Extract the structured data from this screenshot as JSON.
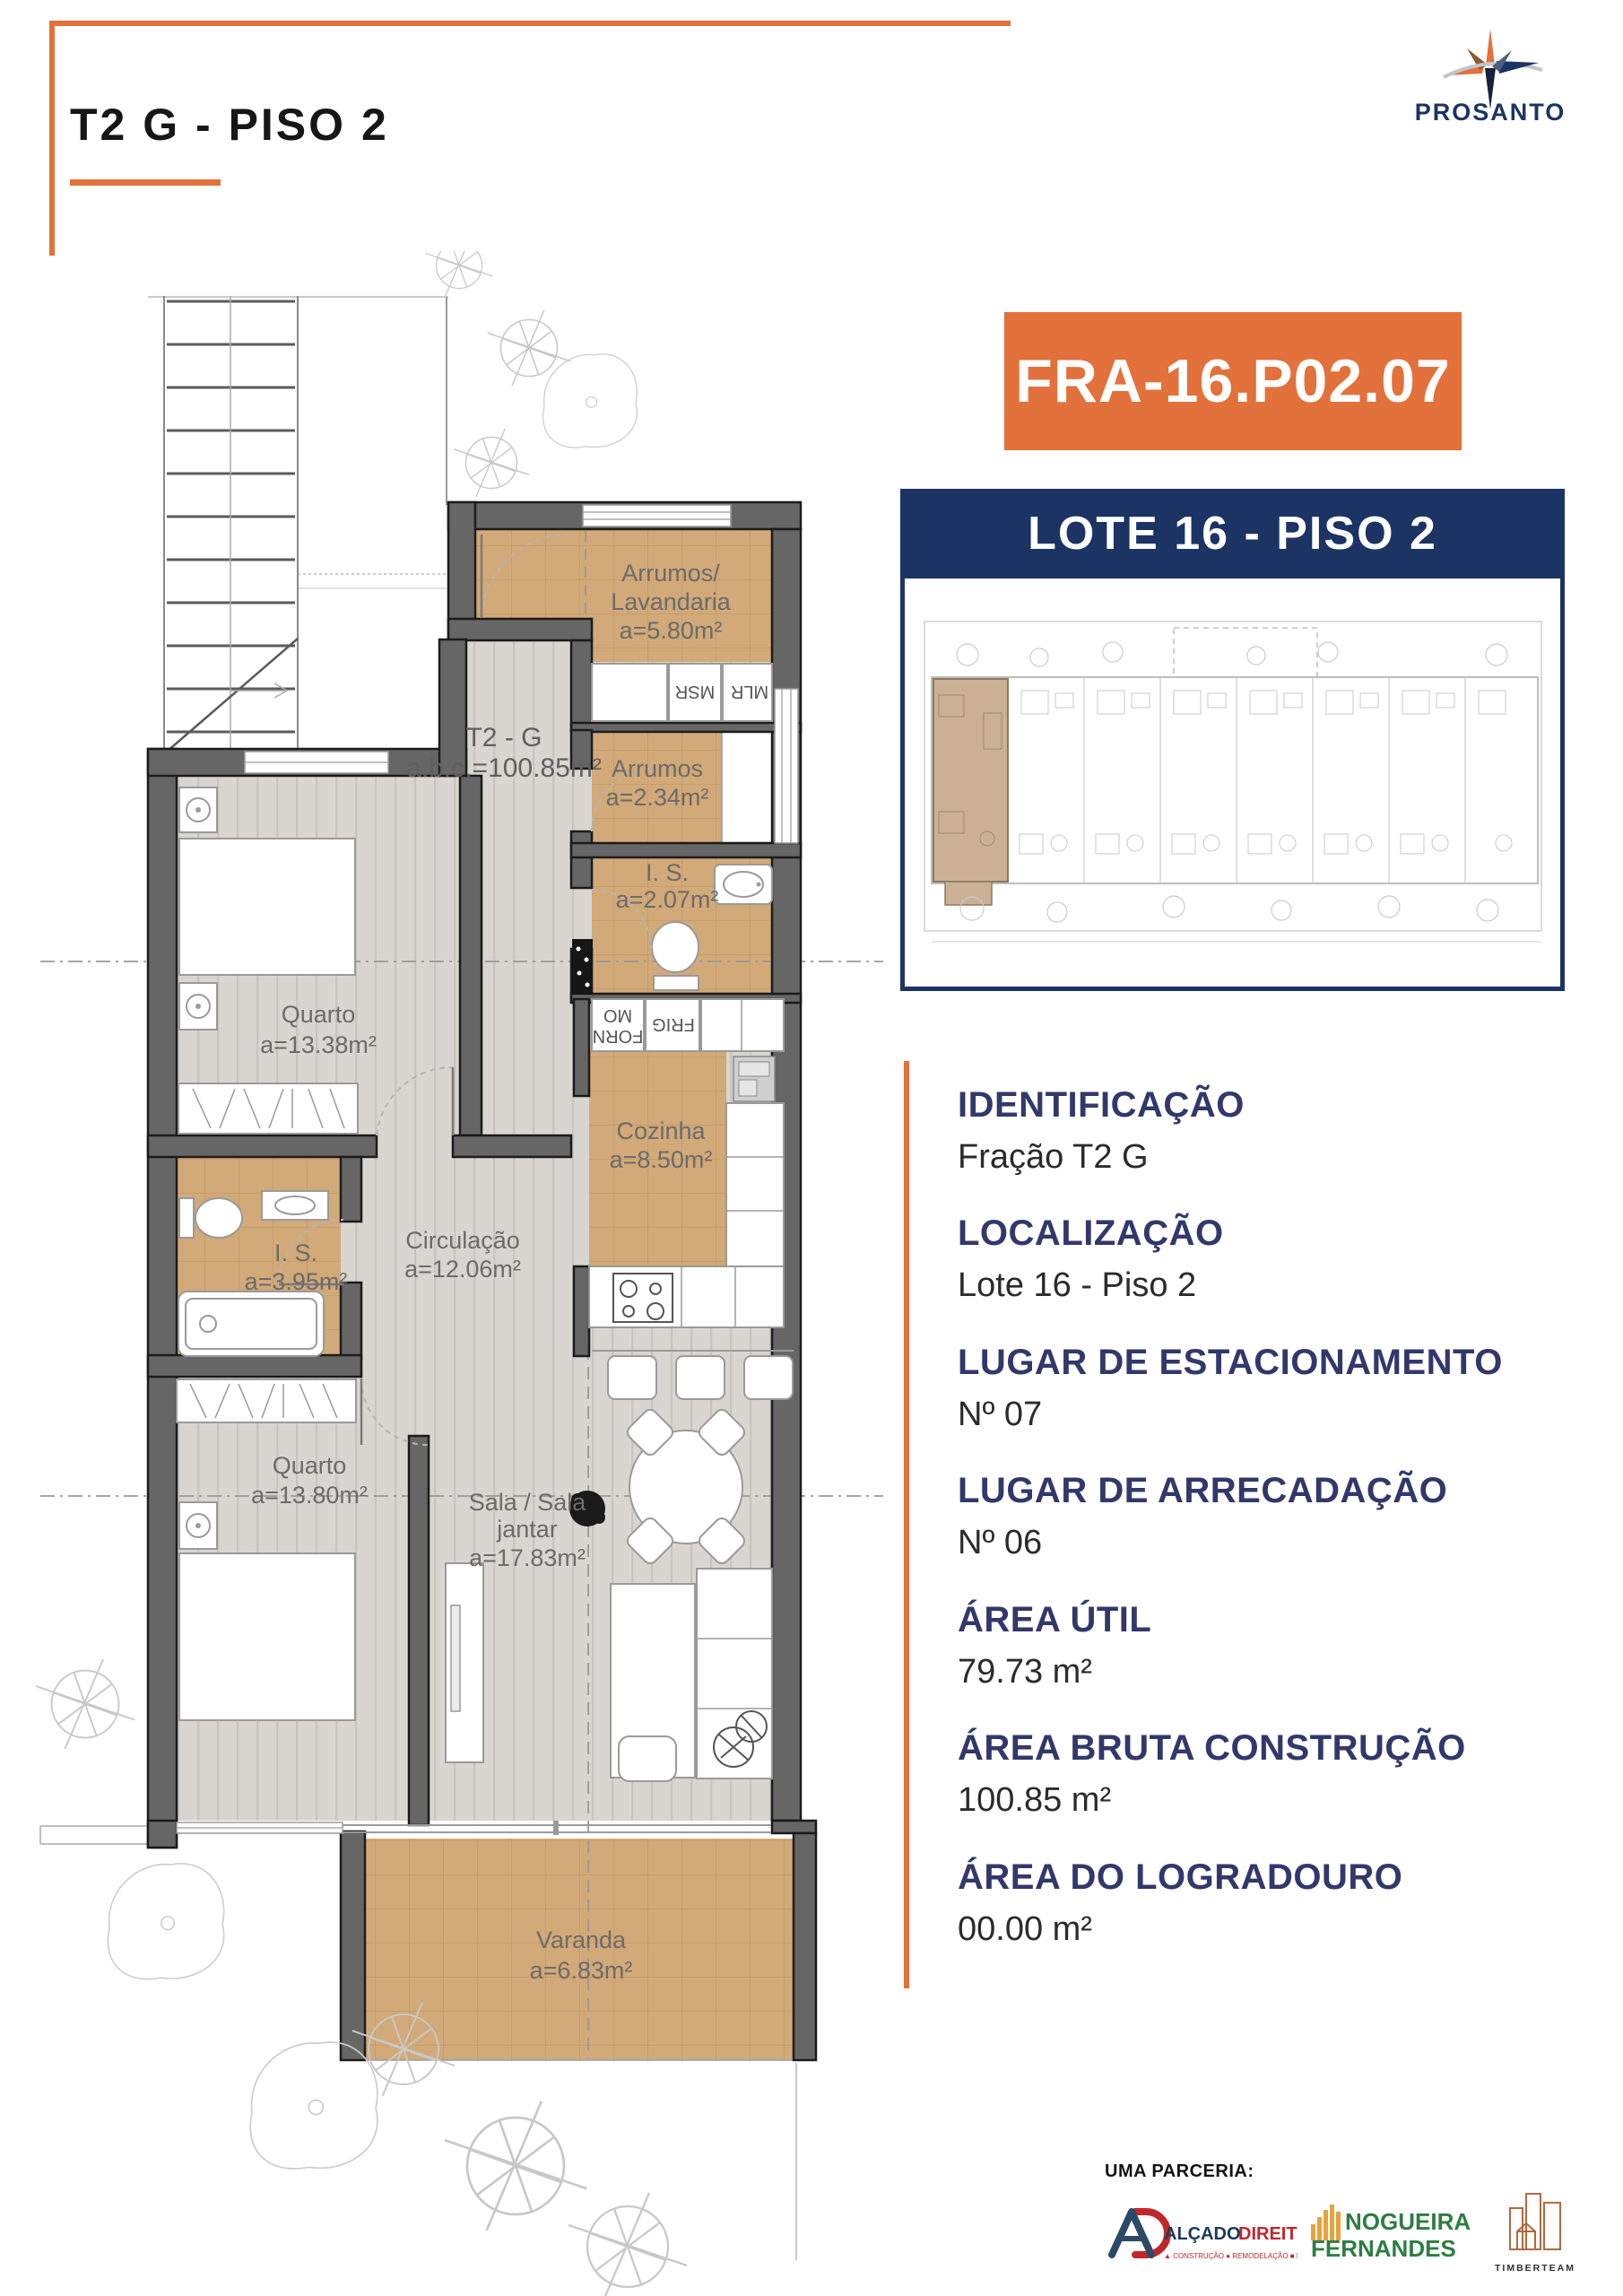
{
  "header": {
    "title": "T2 G - PISO 2",
    "logo_text": "PROSANTO"
  },
  "badge": {
    "code": "FRA-16.P02.07"
  },
  "lote_banner": {
    "label": "LOTE 16 - PISO 2"
  },
  "details": {
    "sections": [
      {
        "heading": "IDENTIFICAÇÃO",
        "value": "Fração T2 G"
      },
      {
        "heading": "LOCALIZAÇÃO",
        "value": "Lote 16 - Piso 2"
      },
      {
        "heading": "LUGAR DE ESTACIONAMENTO",
        "value": "Nº 07"
      },
      {
        "heading": "LUGAR DE ARRECADAÇÃO",
        "value": "Nº 06"
      },
      {
        "heading": "ÁREA ÚTIL",
        "value": "79.73 m²"
      },
      {
        "heading": "ÁREA BRUTA CONSTRUÇÃO",
        "value": "100.85 m²"
      },
      {
        "heading": "ÁREA DO LOGRADOURO",
        "value": "00.00 m²"
      }
    ]
  },
  "floor_plan": {
    "unit_label": {
      "line1": "T2 - G",
      "line2": "a.b.c.=100.85m²"
    },
    "rooms": {
      "laundry": {
        "name1": "Arrumos/",
        "name2": "Lavandaria",
        "area": "a=5.80m²"
      },
      "storage": {
        "name": "Arrumos",
        "area": "a=2.34m²"
      },
      "wc1": {
        "name": "I. S.",
        "area": "a=2.07m²"
      },
      "bedroom1": {
        "name": "Quarto",
        "area": "a=13.38m²"
      },
      "kitchen": {
        "name": "Cozinha",
        "area": "a=8.50m²"
      },
      "hallway": {
        "name": "Circulação",
        "area": "a=12.06m²"
      },
      "wc2": {
        "name": "I. S.",
        "area": "a=3.95m²"
      },
      "bedroom2": {
        "name": "Quarto",
        "area": "a=13.80m²"
      },
      "living": {
        "name1": "Sala / Sala",
        "name2": "jantar",
        "area": "a=17.83m²"
      },
      "balcony": {
        "name": "Varanda",
        "area": "a=6.83m²"
      }
    },
    "appliance_labels": {
      "msr": "MSR",
      "mlr": "MLR",
      "forn": "FORN",
      "mo": "MO",
      "frig": "FRIG"
    }
  },
  "partnership": {
    "label": "UMA PARCERIA:",
    "partners": [
      {
        "name_part1": "ALÇADO",
        "name_part2": "DIREITO",
        "tagline": "▲ CONSTRUÇÃO   ● REMODELAÇÃO   ■ REABILITAÇÃO"
      },
      {
        "name_line1": "NOGUEIRA",
        "name_line2": "FERNANDES"
      },
      {
        "name": "TIMBERTEAM"
      }
    ]
  },
  "colors": {
    "accent_orange": "#E2713B",
    "navy": "#1C3464",
    "heading_navy": "#33386B",
    "floor_tan": "#D2A978",
    "wall_gray": "#666666",
    "partner_green": "#2E7D43",
    "partner_red": "#C0272D"
  }
}
